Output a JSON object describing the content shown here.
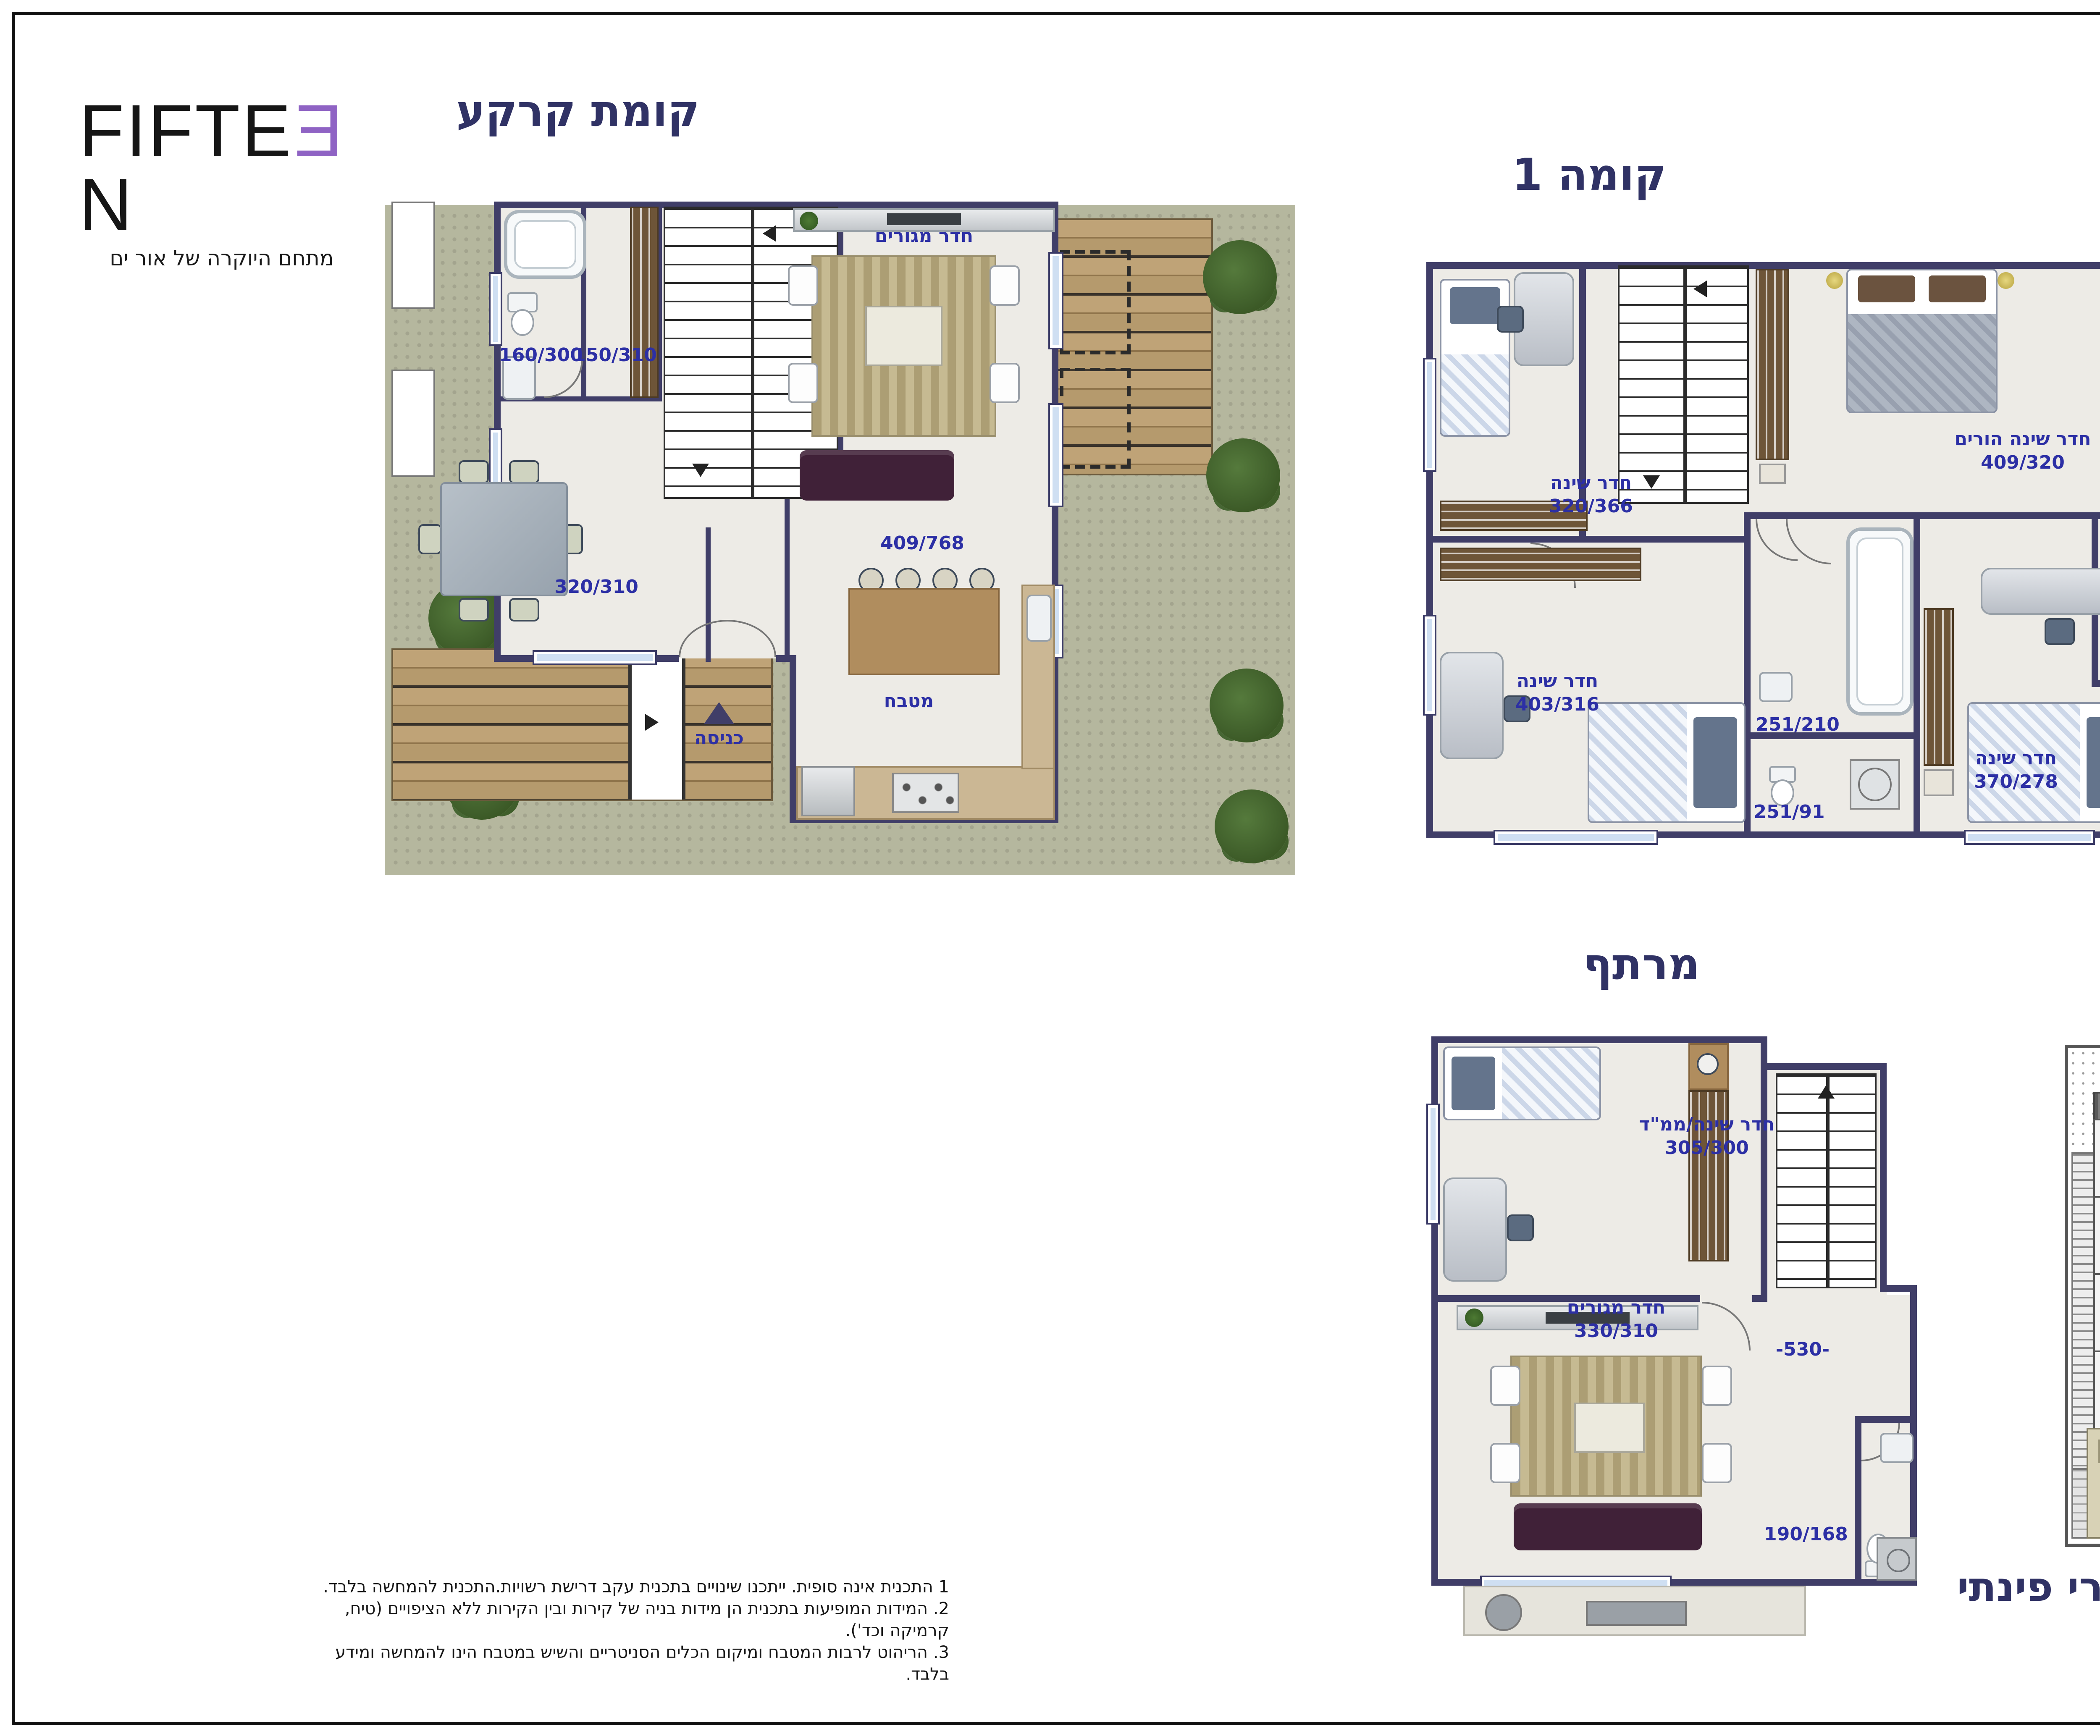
{
  "brand": {
    "fifteen": {
      "prefix": "FIFTE",
      "reversed_e": "E",
      "suffix": "N",
      "tagline": "מתחם היוקרה של אור ים"
    },
    "elnor": {
      "left": "ELN",
      "heart": "♥",
      "right": "R",
      "tagline": "בונים לכם עתיד"
    }
  },
  "titles": {
    "ground": "קומת קרקע",
    "floor1": "קומה 1",
    "basement": "מרתף",
    "unit_type": "קוטג' טורי פינתי"
  },
  "ground_floor": {
    "bath_dim": "160/300",
    "closet_dim": "150/310",
    "living_name": "חדר מגורים",
    "living_dim": "409/768",
    "dining_dim": "320/310",
    "kitchen": "מטבח",
    "entrance": "כניסה"
  },
  "floor1": {
    "bedroom_a_name": "חדר שינה",
    "bedroom_a_dim": "320/366",
    "parents_name": "חדר שינה הורים",
    "parents_dim": "409/320",
    "bath_top_dim": "250/150",
    "bath_mid_dim": "251/210",
    "wc_dim": "251/91",
    "bedroom_b_name": "חדר שינה",
    "bedroom_b_dim": "403/316",
    "bedroom_c_name": "חדר שינה",
    "bedroom_c_dim": "370/278"
  },
  "basement": {
    "mamad_name": "חדר שינה/ממ\"ד",
    "mamad_dim": "305/300",
    "living_name": "חדר מגורים",
    "living_dim": "330/310",
    "level": "-530-",
    "bath_dim": "190/168"
  },
  "notes": [
    "1 התכנית אינה סופית. ייתכנו שינויים בתכנית עקב דרישת רשויות.התכנית להמחשה בלבד.",
    "2. המידות המופיעות בתכנית הן מידות בניה של קירות ובין הקירות ללא הציפויים (טיח, קרמיקה וכד').",
    "3. הריהוט לרבות המטבח ומיקום הכלים הסניטריים והשיש במטבח הינו להמחשה ומידע בלבד."
  ],
  "colors": {
    "wall_navy": "#403e68",
    "label_blue": "#2c2fa5",
    "title_navy": "#303265",
    "grass_green": "#7da358",
    "garden_border": "#b5b79e",
    "elnor_blue": "#45a5e2",
    "elnor_navy": "#2b3a8f",
    "fifteen_purple": "#8f63c4"
  }
}
